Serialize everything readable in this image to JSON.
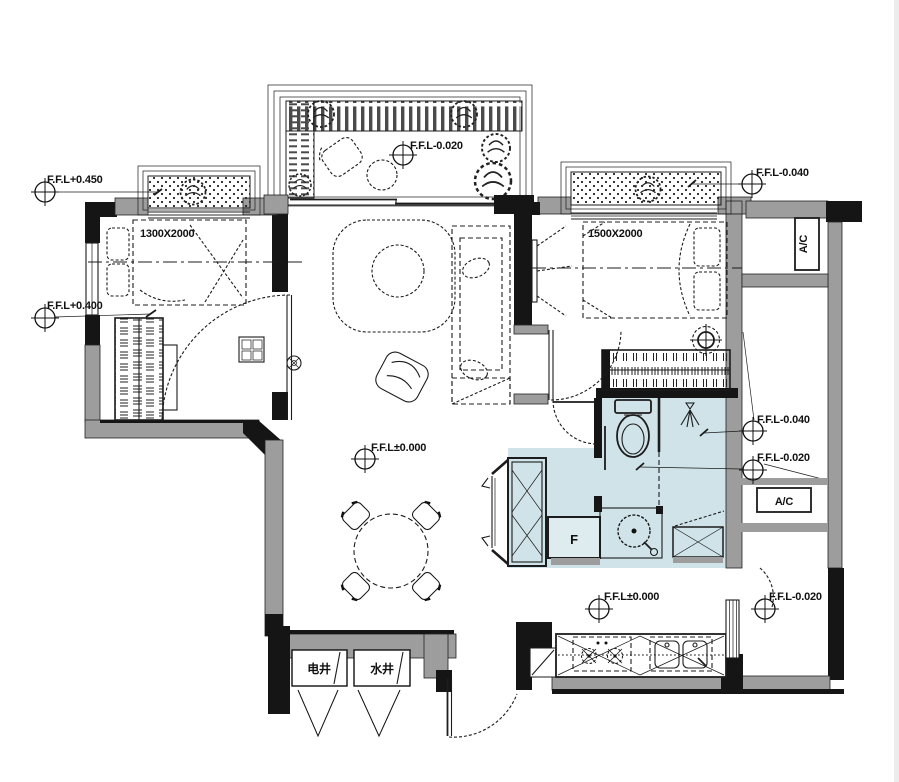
{
  "levels": {
    "left_bay": "F.F.L+0.450",
    "left_room": "F.F.L+0.400",
    "terrace": "F.F.L-0.020",
    "right_bay": "F.F.L-0.040",
    "living": "F.F.L±0.000",
    "service_upper": "F.F.L-0.040",
    "service_lower": "F.F.L-0.020",
    "kitchen": "F.F.L±0.000",
    "entry": "F.F.L-0.020"
  },
  "dimensions": {
    "left_bed": "1300X2000",
    "right_bed": "1500X2000"
  },
  "equipment": {
    "ac_top": "A/C",
    "ac_side": "A/C",
    "fridge": "F"
  },
  "shafts": {
    "electric": "电井",
    "water": "水井"
  },
  "colors": {
    "wall_dark": "#151515",
    "wall_gray": "#9d9d9d",
    "bath_blue": "#cfe3e9",
    "line": "#1c1c1c"
  }
}
